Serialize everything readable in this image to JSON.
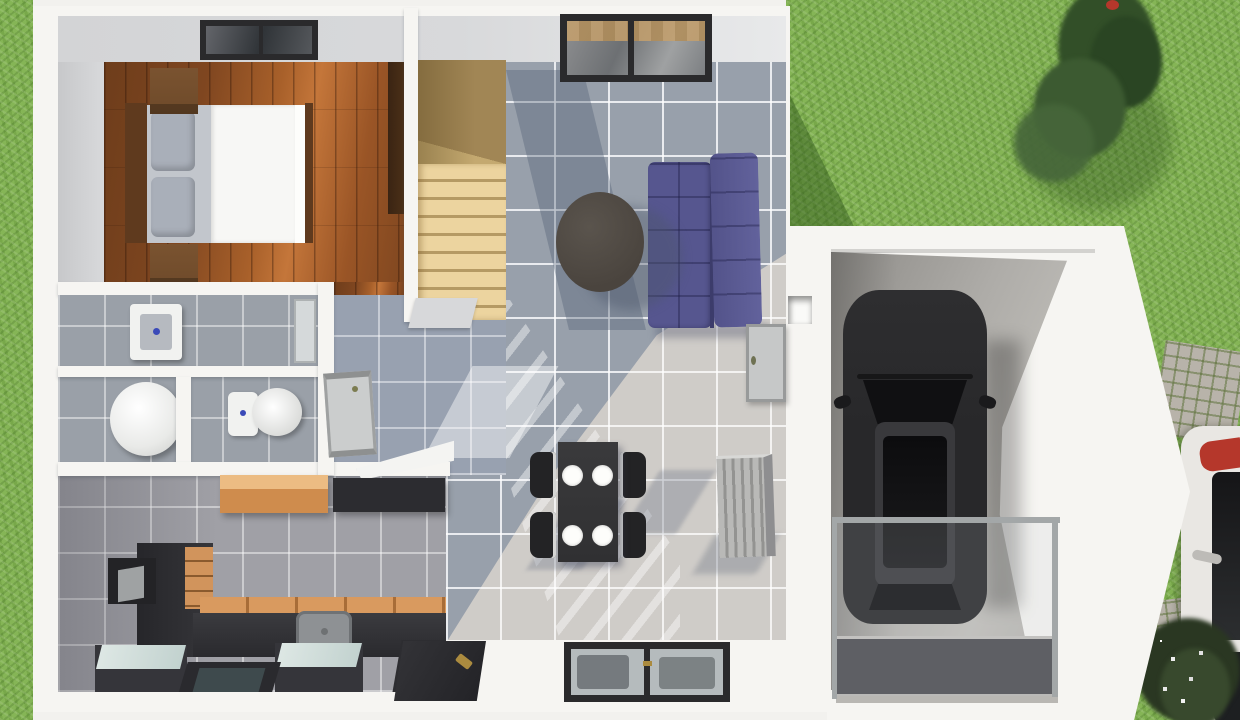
{
  "scene": {
    "type": "3d-floor-plan-render",
    "view": "top-down",
    "description": "Top-down 3D render of a small two-storey house ground floor with attached single garage, lawn, tree, shrubs, cobblestone path and a vehicle parked at the street edge"
  },
  "palette": {
    "sidewalk": "#f2f1ee",
    "grass": "#85b556",
    "grassShadow": "#4a7a2e",
    "tree": "#324f28",
    "treeLight": "#46663a",
    "bush": "#2a3722",
    "wallWhite": "#f6f5f2",
    "wallInner": "#d3d4d6",
    "woodFloor": "#8f4f22",
    "stairWood": "#ecd49f",
    "stairShade": "#b59a64",
    "tileBlue": "#95a0b2",
    "tileLight": "#cfccc8",
    "tileHall": "#98a1b0",
    "tileKitchen": "#a0a0a6",
    "tileBath": "#9aa0a8",
    "sofa": "#56568f",
    "sofaDark": "#3c3c6b",
    "coffeeTable": "#4a443e",
    "diningTable": "#303032",
    "chair": "#232325",
    "plate": "#fdfdfb",
    "bedLinen": "#f7f7f5",
    "pillow": "#a9afb9",
    "bedWood": "#5f3a1e",
    "nightstand": "#6e4a2a",
    "wardrobe": "#4a2f17",
    "cabinetOrange": "#cf8c4d",
    "cabinetDark": "#2c2c30",
    "counterWood": "#d99a5f",
    "concrete": "#aeaca8",
    "carBody": "#28282a",
    "carGlass": "#101012",
    "frameDark": "#2a2a2c",
    "windowGlass": "#b5bbbd",
    "radiator": "#b9b9b7",
    "cobble": "#b8b3aa",
    "whiteCar": "#e9e7e3",
    "accentRed": "#b5372b",
    "gold": "#ab8b3f",
    "fixtureWhite": "#f1f2f0",
    "blueDot": "#3a4ab8",
    "matDark": "#4c4c50",
    "railGray": "#a3a7a8"
  },
  "inventory": {
    "exterior": [
      "lawn",
      "tall tree",
      "flowering shrubs",
      "cobblestone path",
      "driveway",
      "white parked vehicle with red detail"
    ],
    "bedroom": [
      "double bed",
      "two grey pillows",
      "white duvet",
      "wood headboard",
      "two nightstands",
      "wardrobe",
      "skylight window",
      "hardwood floor"
    ],
    "stairwell": [
      "winder wooden staircase",
      "landing step"
    ],
    "living_room": [
      "indigo two-section sofa",
      "dark oval coffee table",
      "sliding glass window",
      "blue-grey tiled floor",
      "radiator",
      "door to garage",
      "wall niche"
    ],
    "dining_area": [
      "dark dining table",
      "four chairs",
      "four white plates",
      "double glazed window"
    ],
    "bathroom_wc": [
      "square shower tray",
      "round white tub",
      "toilet"
    ],
    "hallway": [
      "interior door",
      "white console shelf"
    ],
    "kitchen": [
      "orange wall cabinet",
      "dark wall cabinet",
      "tall unit with orange drawers",
      "counter with sink",
      "two glass-top appliances",
      "glazed dark door",
      "entrance door"
    ],
    "garage": [
      "dark SUV seen from above",
      "concrete floor",
      "glass railing",
      "dark floor mat"
    ]
  }
}
